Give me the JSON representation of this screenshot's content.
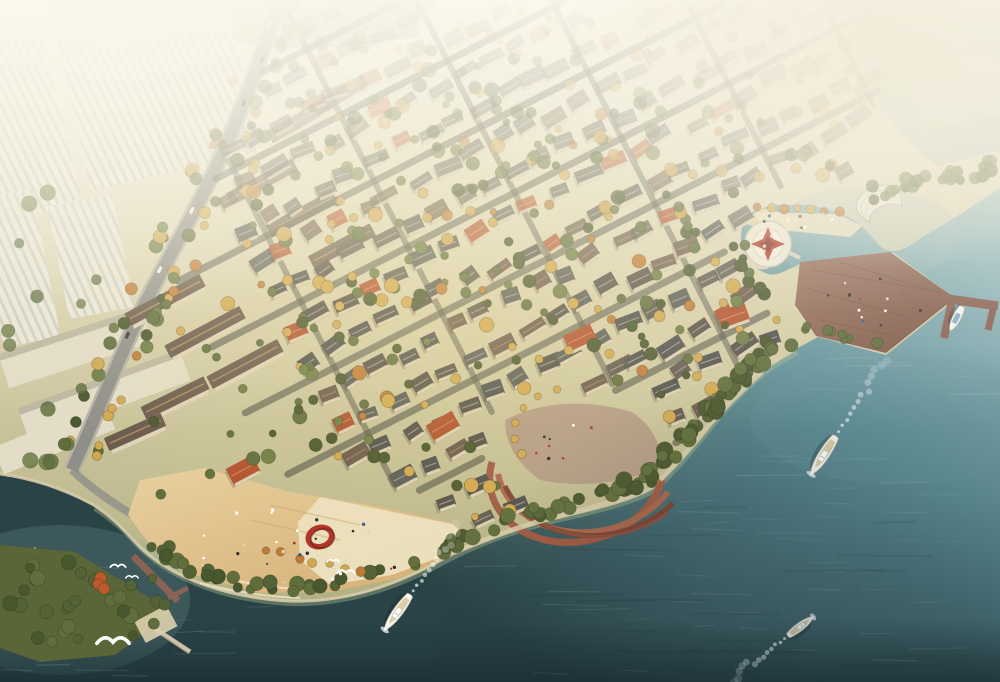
{
  "scene": {
    "kind": "aerial-architectural-rendering",
    "subject": "waterfront-villa-community-masterplan"
  },
  "palette": {
    "landTop": "#f2efe0",
    "landMid": "#d8d0ab",
    "landLow": "#aaa878",
    "waterLight": "#abcacd",
    "waterMid": "#61919a",
    "waterDark": "#2a4347",
    "waterDeep": "#16282b",
    "shallowEdge": "#a9bd8d",
    "sand": "#e8d0a0",
    "sandDark": "#d4ad72",
    "paving": "#ece0c0",
    "terraceBrick": "#a05a44",
    "terraceDark": "#7e4434",
    "gravel": "#b29a86",
    "deck": "#9c7361",
    "deckDark": "#7c5748",
    "pier": "#8a6254",
    "breakwater": "#cfc2a6",
    "treeGreen": "#5f6e3c",
    "treeGreenDark": "#49572e",
    "treeGold": "#d2a74f",
    "treeOrange": "#c07a35",
    "treeRed": "#bf5a2c",
    "roofSlate": "#50514f",
    "roofBrown": "#6a5a4c",
    "roofRed": "#b0512e",
    "wall": "#ded3b6",
    "road": "#8f8f89",
    "roadEdge": "#b5b2a6",
    "street": "#56584e",
    "towerFace": "#ebe7d7",
    "towerStripe": "#c6c2af",
    "slabFace": "#e3dcc6",
    "boatWhite": "#f4f4ef",
    "boatDeck": "#d9c9a0",
    "boatBlue": "#7fa8c9",
    "sculptureRed": "#b03228",
    "compassRed": "#b23c30",
    "plazaWhite": "#eee8d8",
    "quayEdge": "#d8cbaa",
    "gull": "#ffffff",
    "hazeWhite": "#faf7ea",
    "hazeWarm": "#f2ecd9",
    "sunGold": "#f9e498"
  },
  "boats": {
    "moving": [
      {
        "name": "yacht-right",
        "x": 823,
        "y": 456,
        "heading": 213,
        "length": 46,
        "beam": 13,
        "wake": 100
      },
      {
        "name": "yacht-bottom-center",
        "x": 397,
        "y": 613,
        "heading": 216,
        "length": 44,
        "beam": 12,
        "wake": 92
      },
      {
        "name": "motorboat-bottom-right",
        "x": 801,
        "y": 626,
        "heading": 53,
        "length": 32,
        "beam": 10,
        "wake": 78
      }
    ],
    "docked": [
      {
        "name": "docked-boat-pier",
        "x": 956,
        "y": 319,
        "heading": 207,
        "length": 27,
        "beam": 10
      }
    ]
  },
  "birds": [
    {
      "x": 113,
      "y": 641,
      "s": 2.3
    },
    {
      "x": 118,
      "y": 566,
      "s": 1.1
    },
    {
      "x": 132,
      "y": 577,
      "s": 0.9
    },
    {
      "x": 346,
      "y": 572,
      "s": 1.3
    },
    {
      "x": 333,
      "y": 561,
      "s": 0.9
    }
  ],
  "landmarks": {
    "highrise_district": {
      "x": 110,
      "y": 140
    },
    "main_road": {
      "from": [
        282,
        0
      ],
      "to": [
        72,
        470
      ]
    },
    "villa_field_center": {
      "x": 500,
      "y": 260
    },
    "beach_plaza": {
      "x": 300,
      "y": 540
    },
    "red_ring_sculpture": {
      "x": 320,
      "y": 537
    },
    "fan_terraces": {
      "x": 575,
      "y": 450
    },
    "compass_plaza": {
      "x": 768,
      "y": 244
    },
    "shell_pavilion": {
      "x": 880,
      "y": 203
    },
    "deck_promontory": {
      "x": 873,
      "y": 300
    },
    "l_pier": {
      "x": 950,
      "y": 305
    },
    "breakwater": {
      "from": [
        33,
        549
      ],
      "to": [
        190,
        652
      ]
    },
    "green_island": {
      "x": 85,
      "y": 600
    }
  },
  "generator": {
    "seed": 12,
    "villaRows": {
      "origin": [
        140,
        30
      ],
      "angleDeg": -27,
      "rowSpacing": 37,
      "houseSpacing": 30,
      "rows": 18,
      "perRow": 33
    },
    "forcedRedVillas": [
      [
        580,
        338,
        -25
      ],
      [
        443,
        426,
        -30
      ],
      [
        243,
        470,
        -28
      ],
      [
        733,
        316,
        -20
      ]
    ],
    "trees": {
      "villaField": 150,
      "coastBand": 80,
      "coastBandNE": 30,
      "roadSide": 54,
      "city": 26,
      "island": 34,
      "neStrip": 26,
      "deckEdge": 8,
      "lagoonWest": 10
    },
    "people": {
      "beach": 26,
      "deck": 12,
      "quay": 8,
      "fan": 8,
      "compass": 3
    },
    "cars": 7,
    "ripples": {
      "bottomRight": 45,
      "right": 25,
      "bottomLeft": 18,
      "lagoon": 16,
      "darkStreaks": 20
    }
  }
}
